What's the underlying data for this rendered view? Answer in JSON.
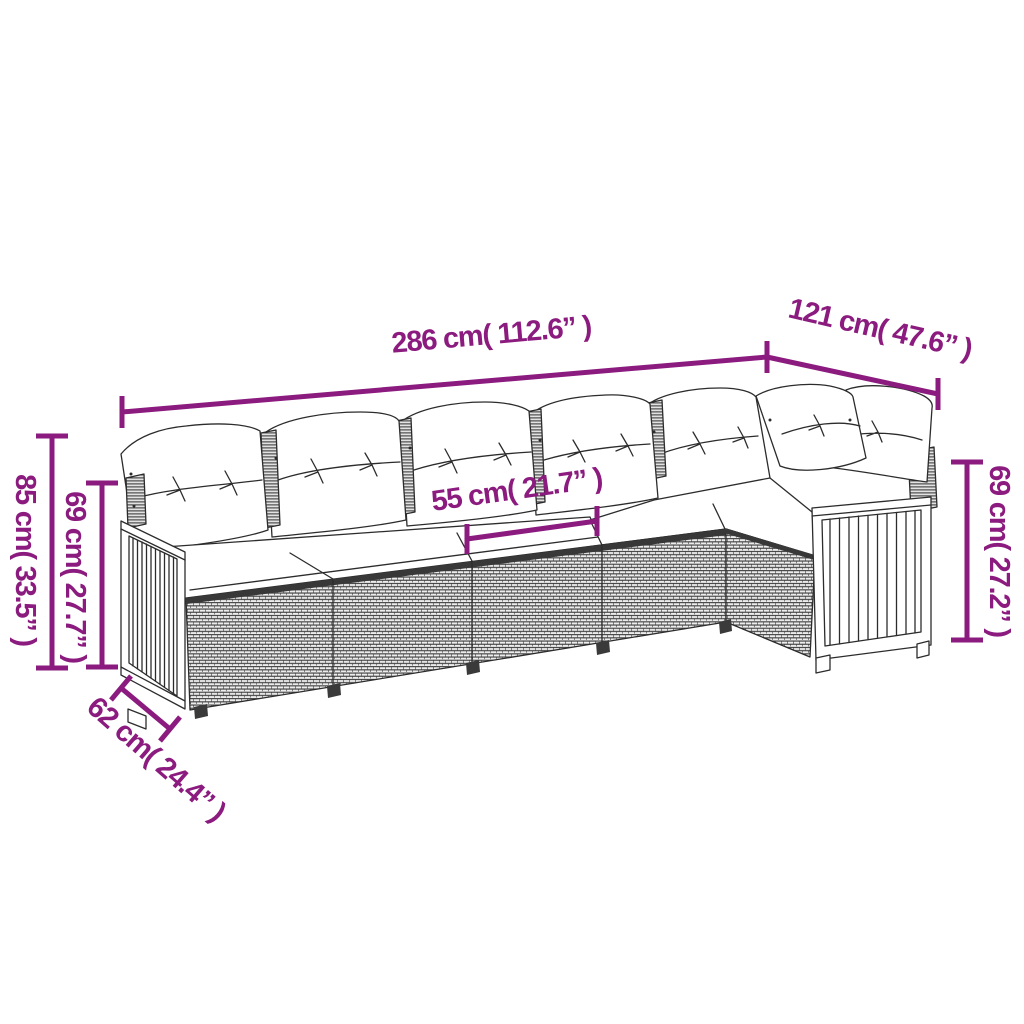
{
  "diagram": {
    "background": "#ffffff",
    "annotation_color": "#8b1b7e",
    "line_art_color": "#2c2c2c",
    "subject": "L-shaped corner sofa with back pillows and seat cushions, wicker base and slatted wood end panels"
  },
  "dimensions": {
    "overall_width": "286 cm( 112.6” )",
    "return_width": "121 cm( 47.6” )",
    "overall_height": "85 cm( 33.5” )",
    "backrest_height_left": "69 cm( 27.7” )",
    "seat_width": "55 cm( 21.7” )",
    "backrest_height_right": "69 cm( 27.2” )",
    "seat_depth": "62 cm( 24.4” )"
  }
}
